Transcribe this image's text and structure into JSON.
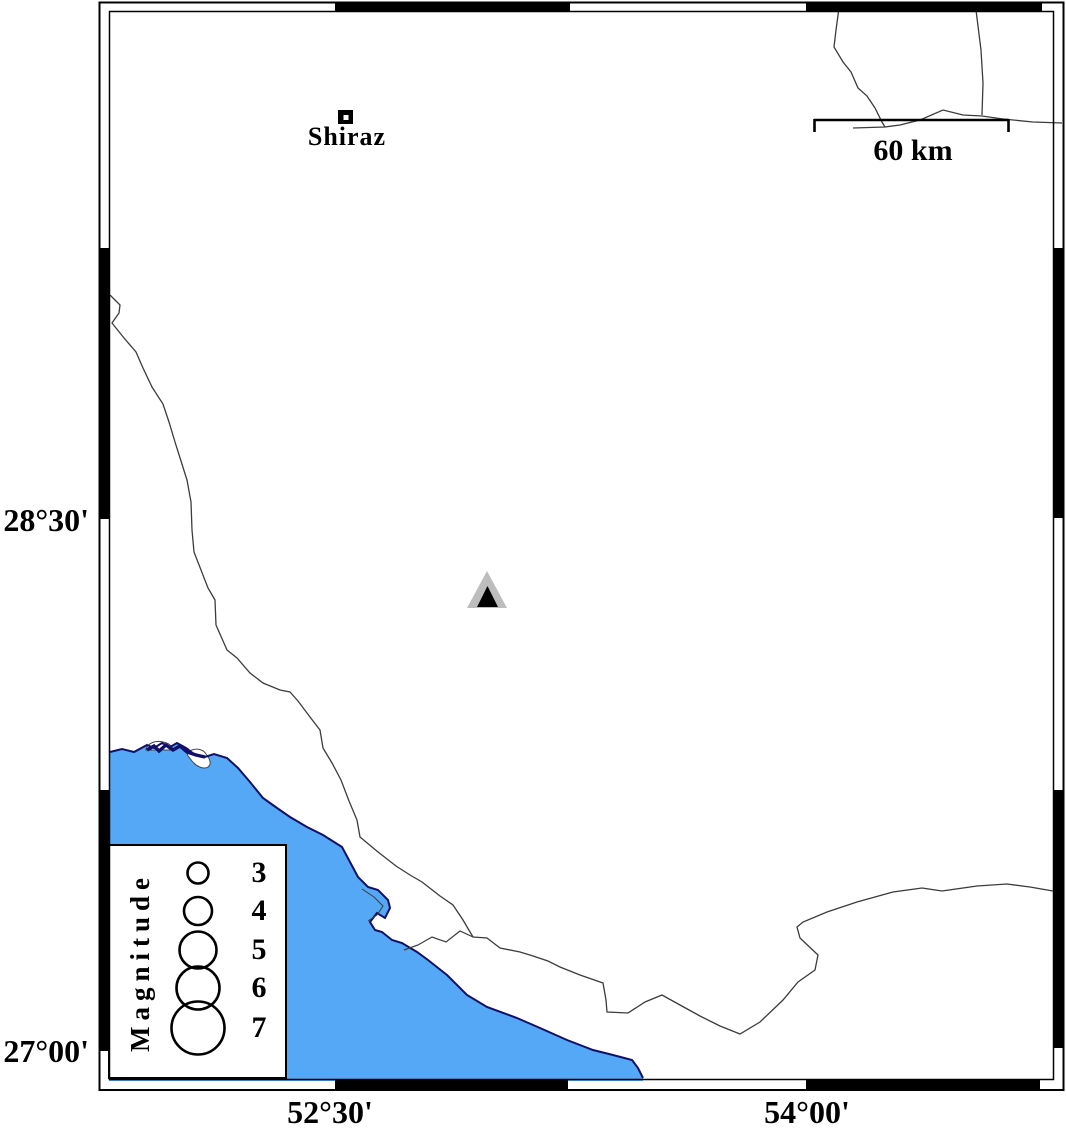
{
  "map_type": "seismicity-station map",
  "city": {
    "name": "Shiraz"
  },
  "station": {
    "symbol": "triangle",
    "fill": "#bdbdbd",
    "inner_fill": "#000000"
  },
  "scale_bar": {
    "label": "60 km"
  },
  "axis_labels": {
    "left": [
      "28°30'",
      "27°00'"
    ],
    "bottom": [
      "52°30'",
      "54°00'"
    ]
  },
  "legend": {
    "title": "Magnitude",
    "items": [
      {
        "magnitude": "3",
        "radius_px": 10.5
      },
      {
        "magnitude": "4",
        "radius_px": 14
      },
      {
        "magnitude": "5",
        "radius_px": 18.5
      },
      {
        "magnitude": "6",
        "radius_px": 21.5
      },
      {
        "magnitude": "7",
        "radius_px": 26.5
      }
    ]
  },
  "colors": {
    "water": "#54a8f5",
    "coast": "#10106a",
    "boundary": "#3c3c3c",
    "frame": "#000000",
    "land": "#ffffff"
  }
}
